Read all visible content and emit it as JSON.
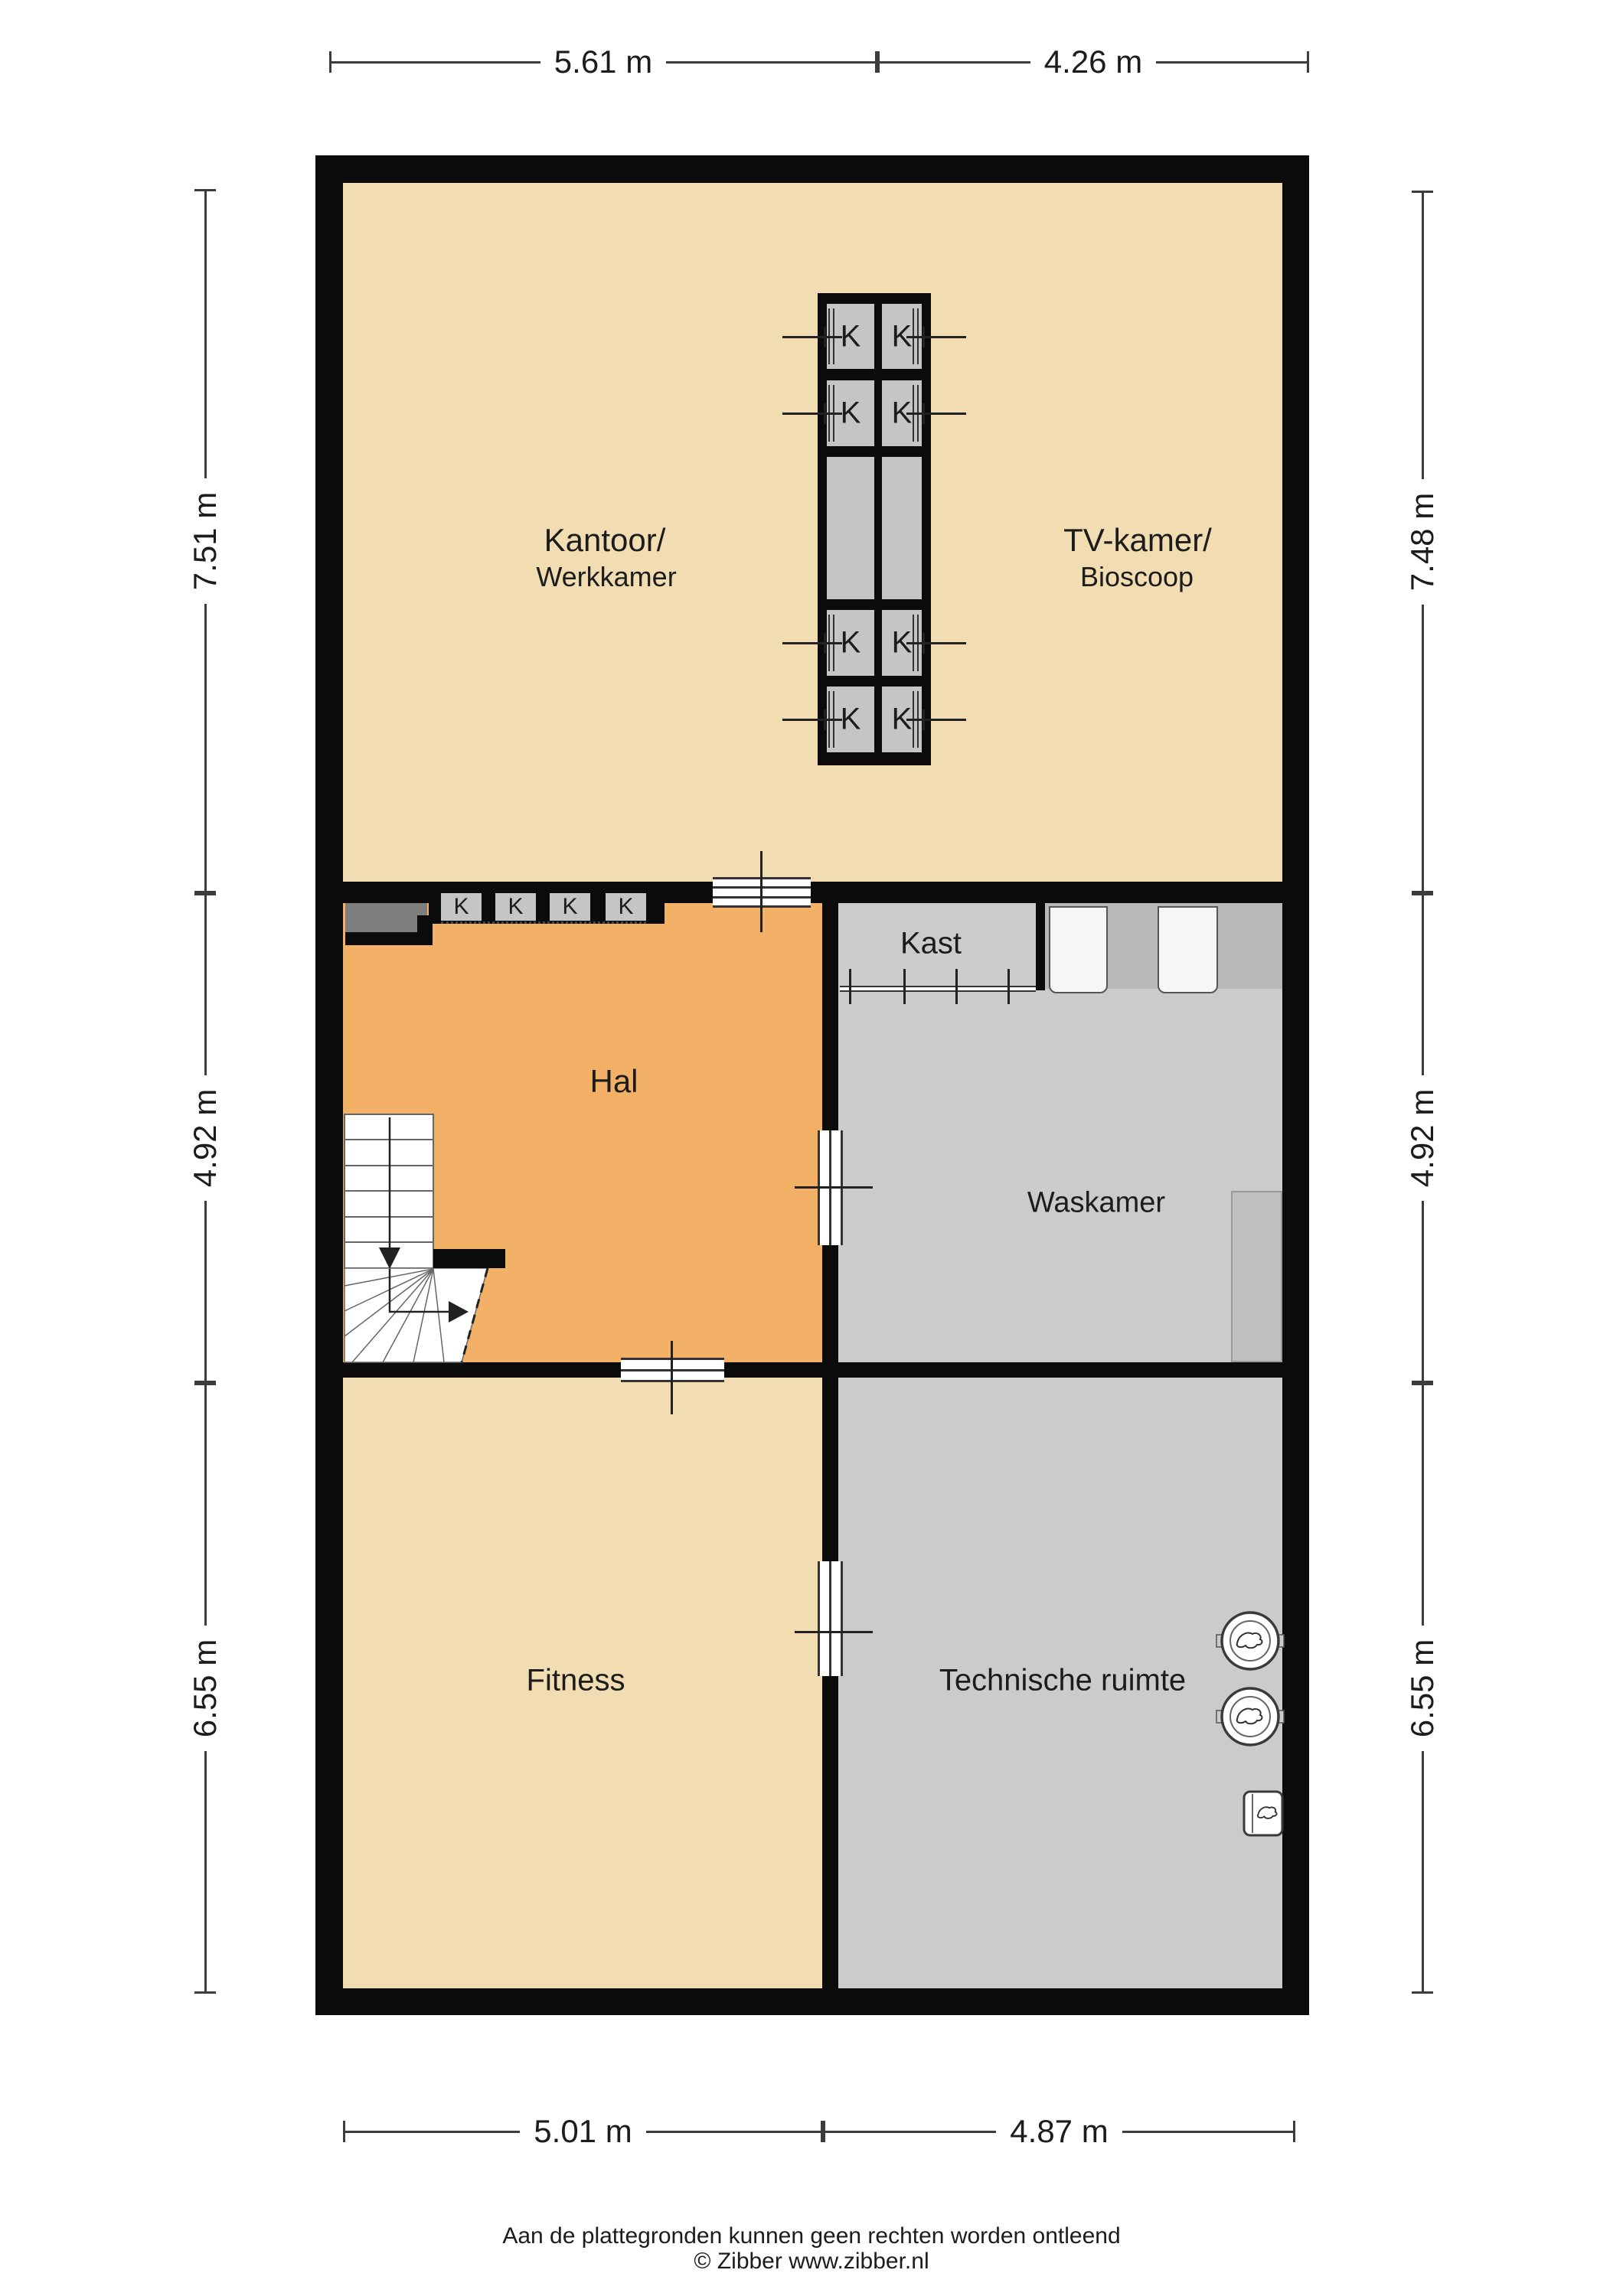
{
  "rooms": {
    "kantoor": {
      "line1": "Kantoor/",
      "line2": "Werkkamer"
    },
    "tv_kamer": {
      "line1": "TV-kamer/",
      "line2": "Bioscoop"
    },
    "hal": {
      "label": "Hal"
    },
    "kast": {
      "label": "Kast"
    },
    "waskamer": {
      "label": "Waskamer"
    },
    "fitness": {
      "label": "Fitness"
    },
    "technische_ruimte": {
      "label": "Technische ruimte"
    }
  },
  "closet": {
    "label": "K"
  },
  "dimensions": {
    "top": [
      {
        "label": "5.61 m"
      },
      {
        "label": "4.26 m"
      }
    ],
    "bottom": [
      {
        "label": "5.01 m"
      },
      {
        "label": "4.87 m"
      }
    ],
    "left": [
      {
        "label": "7.51 m"
      },
      {
        "label": "4.92 m"
      },
      {
        "label": "6.55 m"
      }
    ],
    "right": [
      {
        "label": "7.48 m"
      },
      {
        "label": "4.92 m"
      },
      {
        "label": "6.55 m"
      }
    ]
  },
  "footer": {
    "disclaimer": "Aan de plattegronden kunnen geen rechten worden ontleend",
    "copyright": "© Zibber www.zibber.nl"
  },
  "colors": {
    "floor_tan": "#F2DCB1",
    "floor_orange": "#F3B168",
    "floor_gray": "#CBCBCB",
    "closet_gray": "#C5C5C5",
    "cabinet_gray": "#B8B8B8",
    "niche_gray": "#7D7D7D",
    "wall_black": "#0B0B0B",
    "dimension_line": "#3C3C3C"
  }
}
